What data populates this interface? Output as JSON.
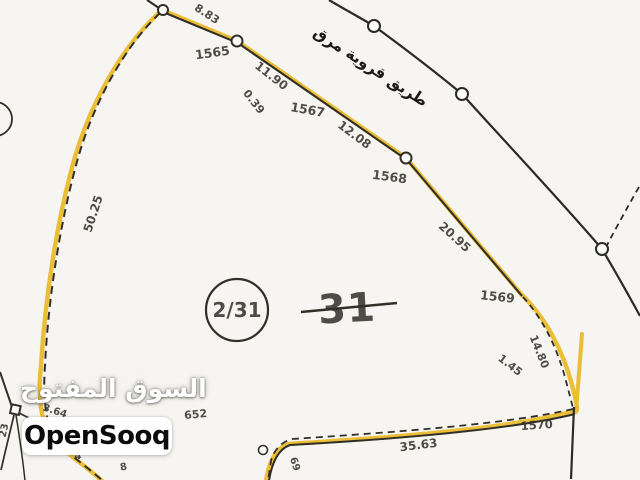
{
  "watermark": {
    "brand_arabic": "السوق المفتوح",
    "brand_latin": "OpenSooq"
  },
  "map": {
    "road_label": "طريق قروية مرق",
    "parcel": {
      "circled_ref": "2/31",
      "plot_number": "31"
    },
    "points": {
      "p1565": "1565",
      "p1567": "1567",
      "p1568": "1568",
      "p1569": "1569",
      "p1570": "1570",
      "p652": "652"
    },
    "measurements": {
      "m8_83": "8.83",
      "m11_90": "11.90",
      "m0_39": "0.39",
      "m12_08": "12.08",
      "m20_95": "20.95",
      "m14_80": "14.80",
      "m1_45": "1.45",
      "m50_25": "50.25",
      "m35_63": "35.63"
    },
    "small_numbers": {
      "n23": "23",
      "n3_64": "3.64",
      "n4": "4",
      "n8": "8",
      "n69": "69"
    }
  },
  "colors": {
    "highlight_yellow": "#e8b92f",
    "map_ink": "#34312b",
    "paper": "#f6f5f1",
    "watermark_text": "#ffffff",
    "watermark_box": "#ffffff"
  }
}
